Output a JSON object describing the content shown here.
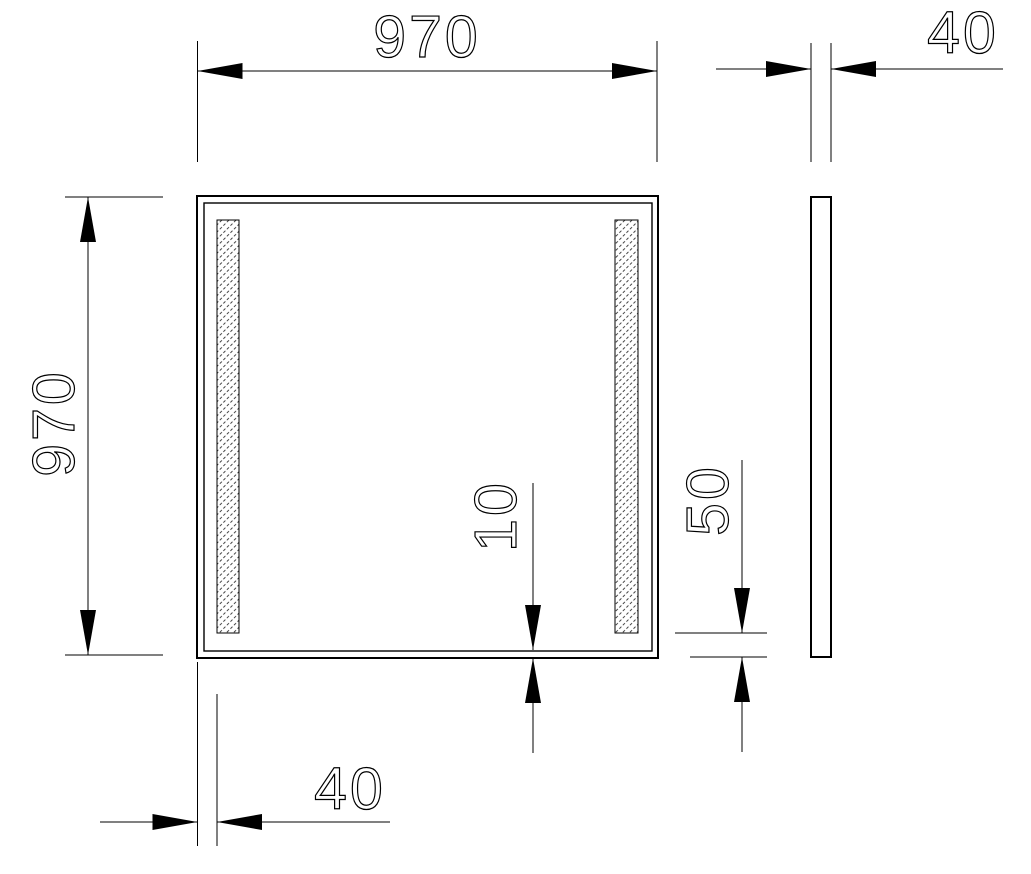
{
  "colors": {
    "background": "#ffffff",
    "line": "#000000",
    "hatch": "#444444"
  },
  "drawing": {
    "kind": "technical-dimension-drawing",
    "dimensions": {
      "top_width": "970",
      "left_height": "970",
      "side_thickness": "40",
      "strip_side_offset": "40",
      "strip_bottom_offset": "50",
      "frame_edge_gap": "10"
    }
  }
}
